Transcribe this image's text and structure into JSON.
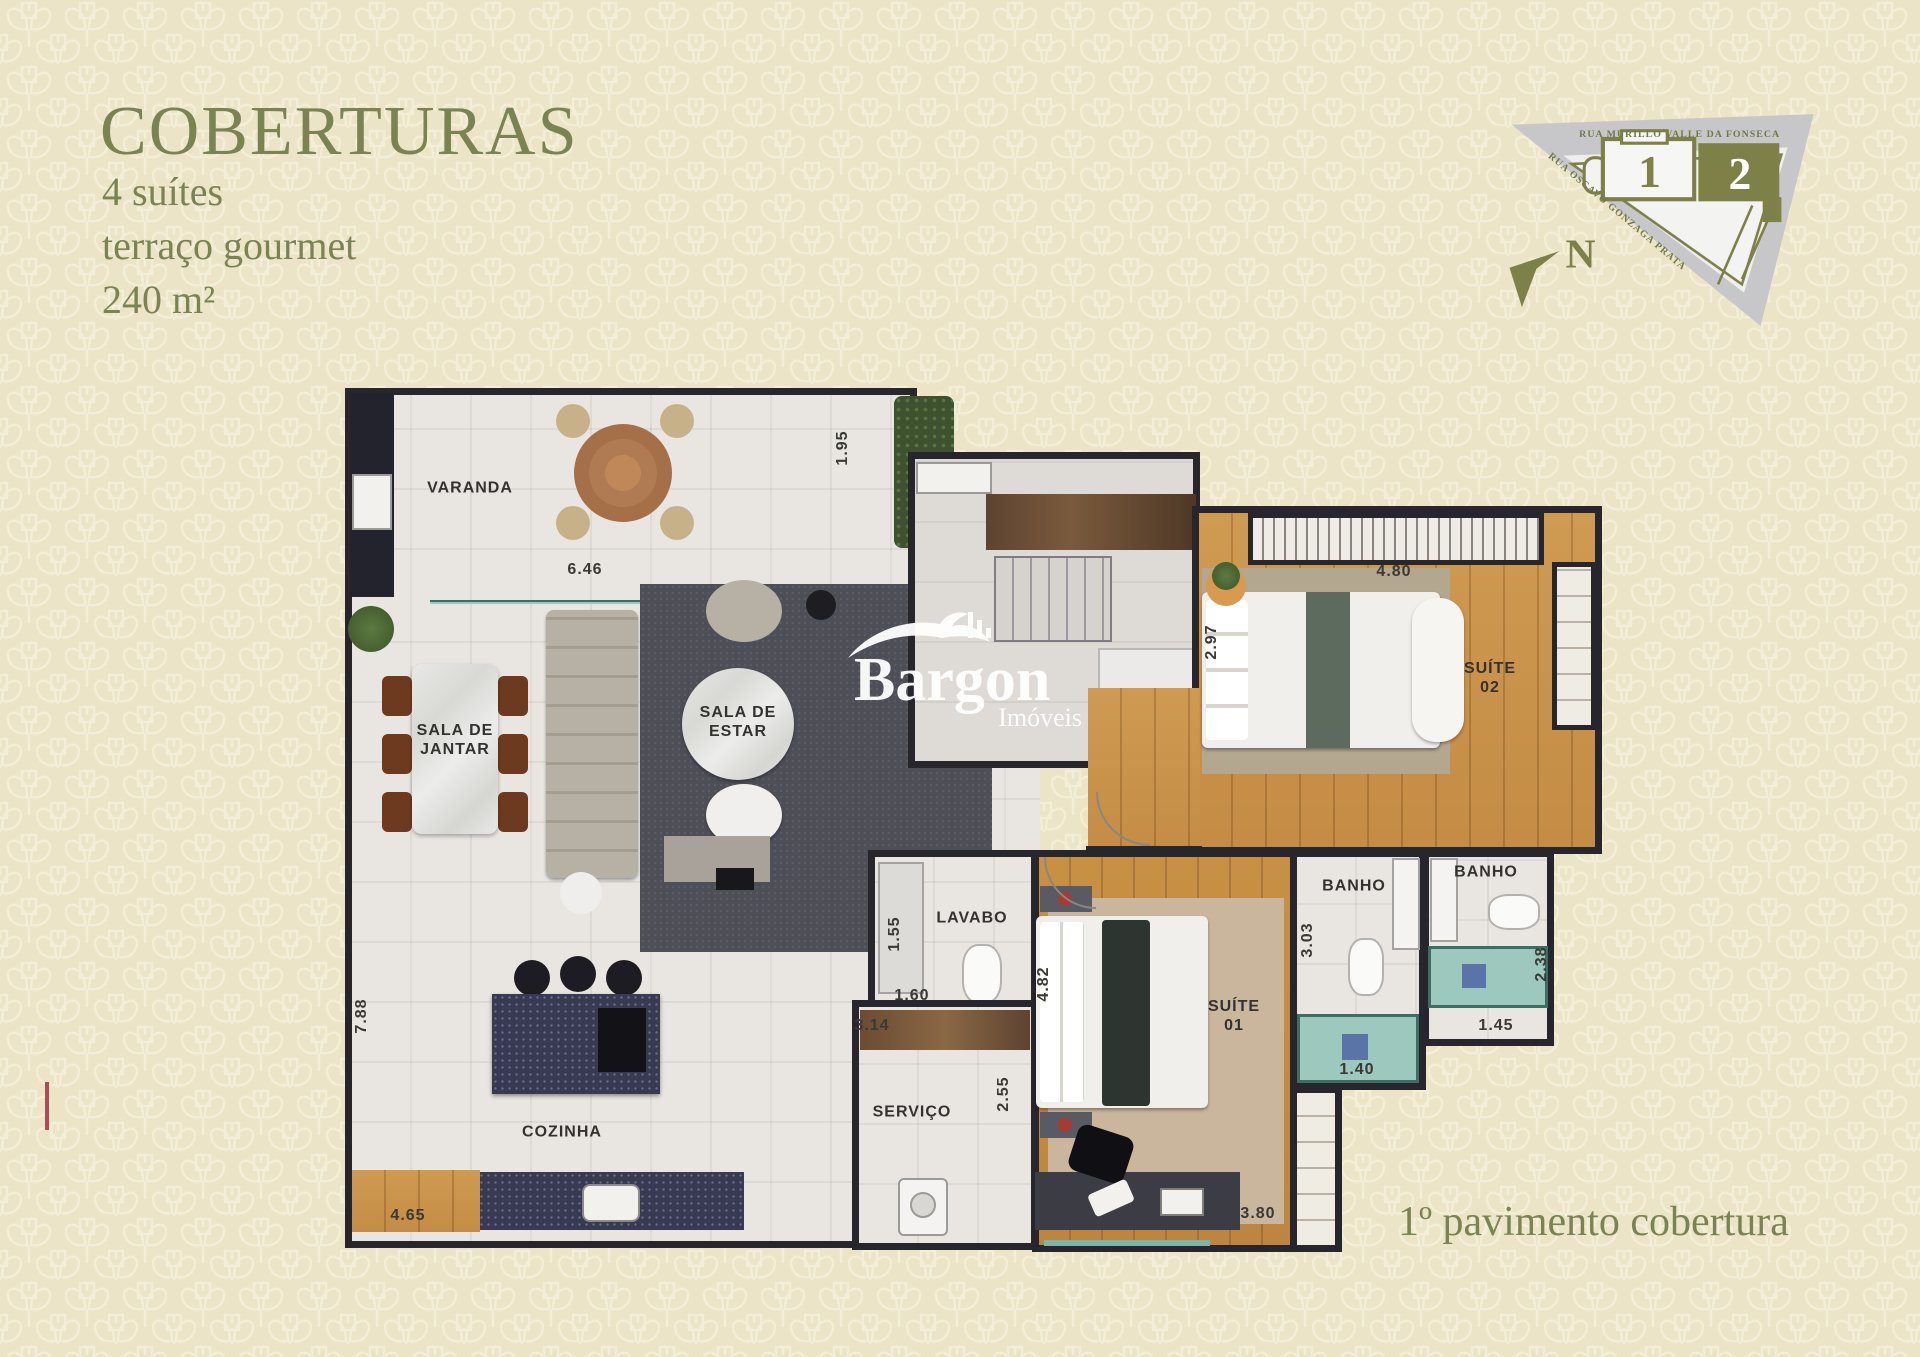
{
  "page": {
    "background_color": "#ebe4c6",
    "accent_color": "#7a8453",
    "wall_color": "#26262c",
    "wood_color": "#cf9a52",
    "teal_color": "#9cc8bd",
    "island_color": "#383a52"
  },
  "header": {
    "title": "COBERTURAS",
    "features": [
      {
        "label": "4 suítes"
      },
      {
        "label": "terraço gourmet"
      },
      {
        "label": "240 m²"
      }
    ]
  },
  "site_map": {
    "street_top": "RUA MURILLO VALLE DA FONSECA",
    "street_diagonal": "RUA OSCAVO GONZAGA PRATA",
    "building_1": "1",
    "building_2": "2",
    "north_letter": "N"
  },
  "watermark": {
    "brand": "Bargon",
    "tagline": "Imóveis"
  },
  "plan": {
    "rooms": [
      {
        "label": "VARANDA"
      },
      {
        "label": "SALA DE\nJANTAR"
      },
      {
        "label": "SALA DE\nESTAR"
      },
      {
        "label": "COZINHA"
      },
      {
        "label": "LAVABO"
      },
      {
        "label": "SERVIÇO"
      },
      {
        "label": "SUÍTE\n01"
      },
      {
        "label": "SUÍTE\n02"
      },
      {
        "label": "BANHO"
      },
      {
        "label": "BANHO"
      }
    ],
    "dimensions": [
      {
        "value": "6.46"
      },
      {
        "value": "1.95"
      },
      {
        "value": "2.97"
      },
      {
        "value": "4.80"
      },
      {
        "value": "7.88"
      },
      {
        "value": "4.65"
      },
      {
        "value": "1.55"
      },
      {
        "value": "1.60"
      },
      {
        "value": "3.14"
      },
      {
        "value": "2.55"
      },
      {
        "value": "4.82"
      },
      {
        "value": "3.03"
      },
      {
        "value": "1.40"
      },
      {
        "value": "1.45"
      },
      {
        "value": "2.38"
      },
      {
        "value": "3.80"
      }
    ]
  },
  "footer": {
    "caption": "1º pavimento cobertura"
  }
}
